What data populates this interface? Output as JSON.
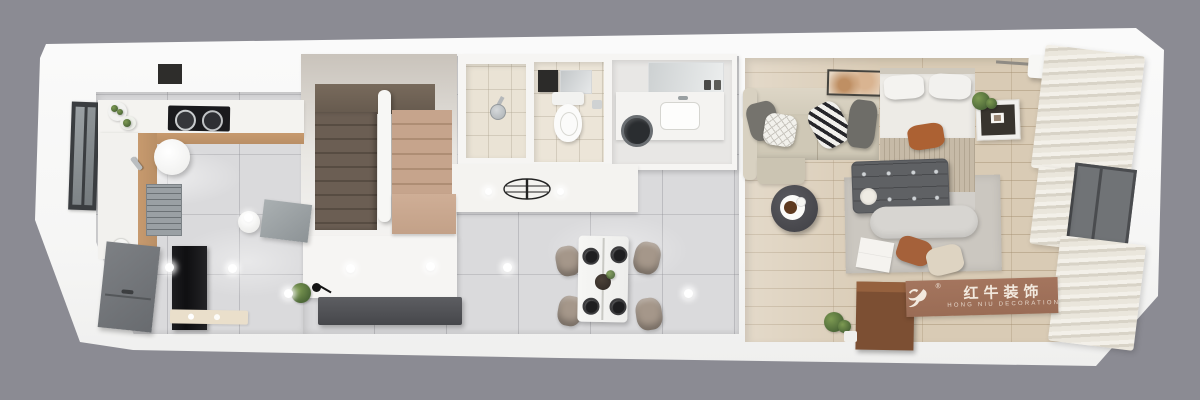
{
  "scene": {
    "type": "3d-floor-plan-render",
    "view": "top-down isometric apartment cutaway",
    "colors": {
      "background": "#8b8b93",
      "wall": "#f7f7f6",
      "marble_floor": "#dadadc",
      "wood_floor": "#d9cbb5",
      "counter_wood": "#b98f66",
      "stair_dark": "#6b5e53",
      "stair_light": "#c6a48c",
      "sofa_beige": "#cfc8b6",
      "ottoman_gray": "#5f6164",
      "rust_accent": "#ac6133",
      "curtain_light": "#ece8de",
      "sign_panel": "#a4755e",
      "sign_text": "#f2e9de"
    },
    "rooms": [
      "kitchen",
      "staircase",
      "under-stair-storage",
      "hallway",
      "shower-room",
      "toilet-room",
      "laundry-room",
      "dining-area",
      "living-bedroom"
    ],
    "furniture": [
      "kitchen-window",
      "upper-cabinets",
      "cooktop",
      "cooking-pots",
      "vegetable-plates",
      "kitchen-faucet",
      "kitchen-sink",
      "plate-stack",
      "refrigerator",
      "round-table",
      "stool",
      "gray-sideboard",
      "kitchen-mat",
      "u-shaped-stairs",
      "stair-railing",
      "under-stair-cabinet",
      "shower-head",
      "toilet",
      "bathroom-vanity",
      "bathroom-mirror",
      "washbasin-counter",
      "washing-machine",
      "ceiling-drying-rack",
      "recessed-downlights",
      "dining-table",
      "dining-chairs",
      "place-settings",
      "console-desk",
      "desk-lamp",
      "potted-plant",
      "sofa",
      "throw-pillows",
      "wall-art",
      "coffee-table",
      "double-bed",
      "bed-pillows",
      "tufted-ottoman",
      "bed-bench",
      "area-rug",
      "nightstand",
      "air-conditioner",
      "curtains",
      "bedroom-window",
      "wood-dresser",
      "floor-plant"
    ]
  },
  "watermark": {
    "logo": "bull-logo",
    "registered_mark": "®",
    "brand_cn": "红牛装饰",
    "brand_en": "HONG NIU DECORATION"
  }
}
